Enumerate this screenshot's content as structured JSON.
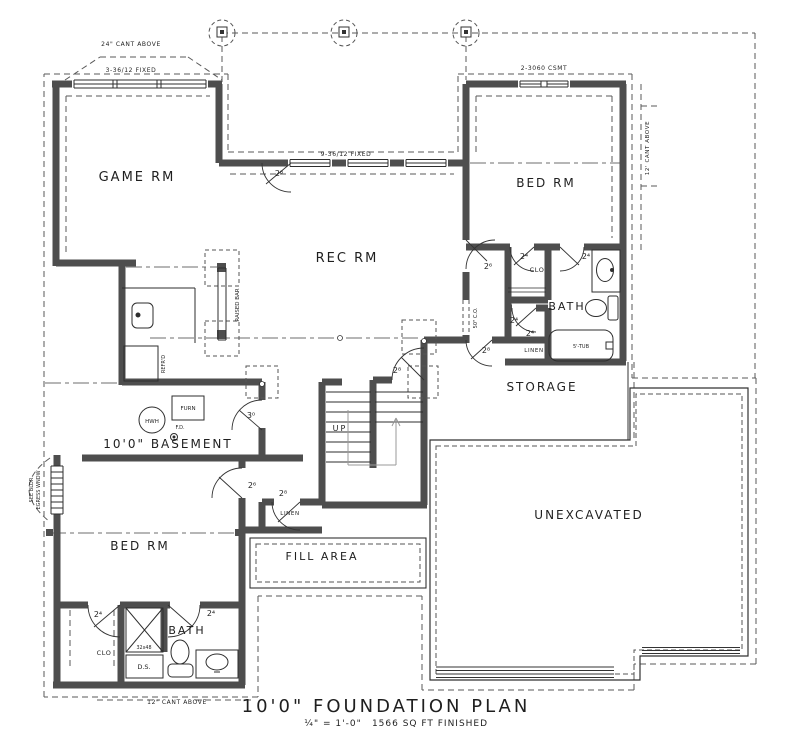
{
  "plan": {
    "rooms": {
      "game_rm": "GAME RM",
      "bed_rm_upper": "BED RM",
      "rec_rm": "REC RM",
      "clo_upper": "CLO",
      "bath_upper": "BATH",
      "linen_upper": "LINEN",
      "storage": "STORAGE",
      "basement": "10'0\" BASEMENT",
      "bed_rm_lower": "BED RM",
      "linen_lower": "LINEN",
      "fill_area": "FILL AREA",
      "unexcavated": "UNEXCAVATED",
      "clo_lower": "CLO",
      "bath_lower": "BATH"
    },
    "fixtures": {
      "hwh": "HWH",
      "furnace": "FURN",
      "floor_drain": "F.D.",
      "tub": "5'-TUB",
      "shower_size": "32x48",
      "downspout": "D.S.",
      "refrigerator": "REFR'D",
      "raised_bar": "RAISED BAR",
      "stairs_up": "UP"
    },
    "annotations": {
      "cant_above_top": "24\" CANT ABOVE",
      "fixed_windows_left": "3-36/12 FIXED",
      "fixed_windows_mid": "9-36/12 FIXED",
      "casement_window": "2-3060 CSMT",
      "cant_above_right": "12' CANT ABOVE",
      "cant_above_bottom": "12\" CANT ABOVE",
      "cased_opening": "50\" C.O.",
      "egress_line1": "SEE BLDR",
      "egress_line2": "EGRESS WNDW"
    },
    "doors": [
      {
        "id": "exterior-patio",
        "label": "2⁸"
      },
      {
        "id": "hall-upper",
        "label": "2⁶"
      },
      {
        "id": "clo-upper",
        "label": "2⁴"
      },
      {
        "id": "bath-upper",
        "label": "2⁴"
      },
      {
        "id": "linen-upper",
        "label": "2⁴"
      },
      {
        "id": "tub-closet",
        "label": "2⁴"
      },
      {
        "id": "storage",
        "label": "2⁸"
      },
      {
        "id": "stairs",
        "label": "2⁸"
      },
      {
        "id": "basement",
        "label": "3⁰"
      },
      {
        "id": "bed-rm-lower",
        "label": "2⁶"
      },
      {
        "id": "linen-lower",
        "label": "2⁸"
      },
      {
        "id": "clo-lower",
        "label": "2⁴"
      },
      {
        "id": "bath-lower",
        "label": "2⁴"
      }
    ],
    "title_block": {
      "title": "10'0\" FOUNDATION PLAN",
      "scale": "¼\" = 1'-0\"",
      "area": "1566 SQ FT FINISHED"
    }
  }
}
